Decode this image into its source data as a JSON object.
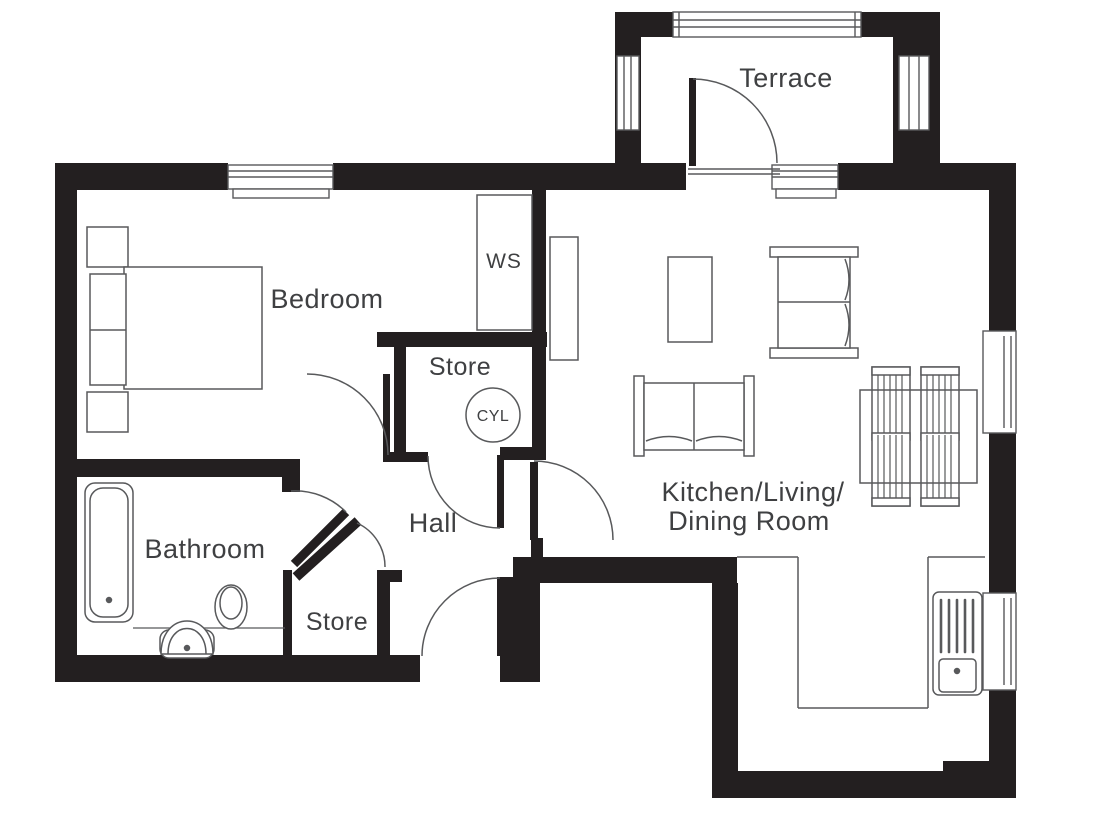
{
  "floorplan": {
    "rooms": {
      "terrace": "Terrace",
      "bedroom": "Bedroom",
      "hall": "Hall",
      "bathroom": "Bathroom",
      "kitchen_line1": "Kitchen/Living/",
      "kitchen_line2": "Dining Room",
      "store_upper": "Store",
      "store_lower": "Store",
      "wardrobe": "WS",
      "cylinder": "CYL"
    },
    "colors": {
      "wall": "#231f20",
      "furniture_line": "#58595b",
      "label_text": "#3f4042",
      "background": "#ffffff"
    }
  }
}
